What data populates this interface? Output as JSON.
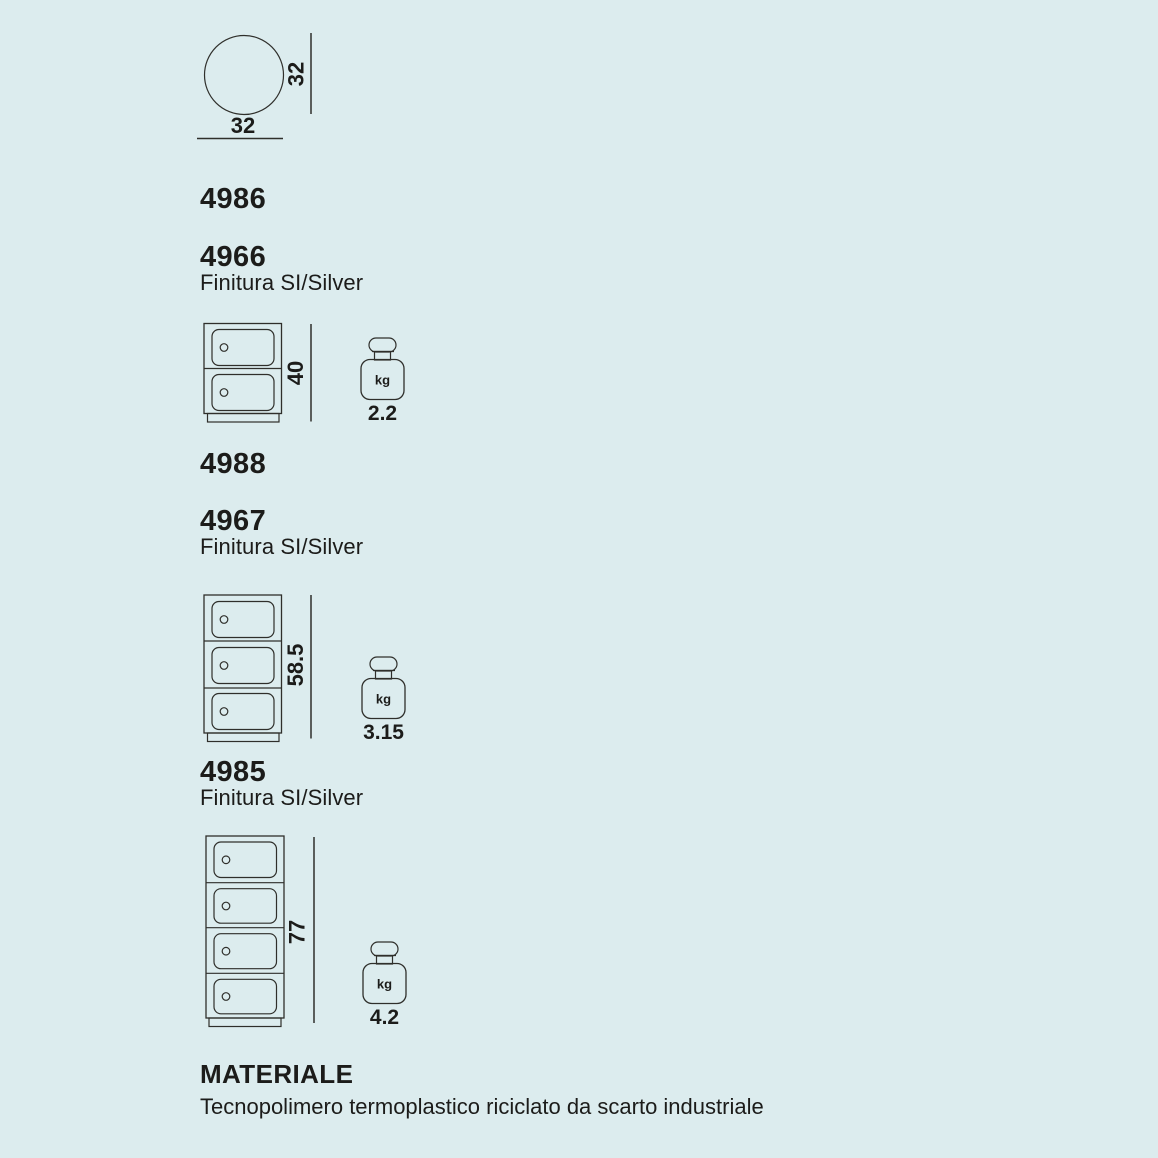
{
  "page": {
    "background": "#dcecee",
    "ink": "#1c1c1a",
    "line_color": "#2f2f2b"
  },
  "top_view": {
    "shape": "circle-top-view",
    "width_label": "32",
    "height_label": "32"
  },
  "items": [
    {
      "code": "4986"
    },
    {
      "code": "4966",
      "finish": "Finitura SI/Silver",
      "drawing": {
        "drawers": 2,
        "height_label": "40",
        "weight_unit": "kg",
        "weight_value": "2.2"
      }
    },
    {
      "code": "4988"
    },
    {
      "code": "4967",
      "finish": "Finitura SI/Silver",
      "drawing": {
        "drawers": 3,
        "height_label": "58.5",
        "weight_unit": "kg",
        "weight_value": "3.15"
      }
    },
    {
      "code": "4985",
      "finish": "Finitura SI/Silver",
      "drawing": {
        "drawers": 4,
        "height_label": "77",
        "weight_unit": "kg",
        "weight_value": "4.2"
      }
    }
  ],
  "material": {
    "title": "MATERIALE",
    "description": "Tecnopolimero termoplastico riciclato da scarto industriale"
  }
}
